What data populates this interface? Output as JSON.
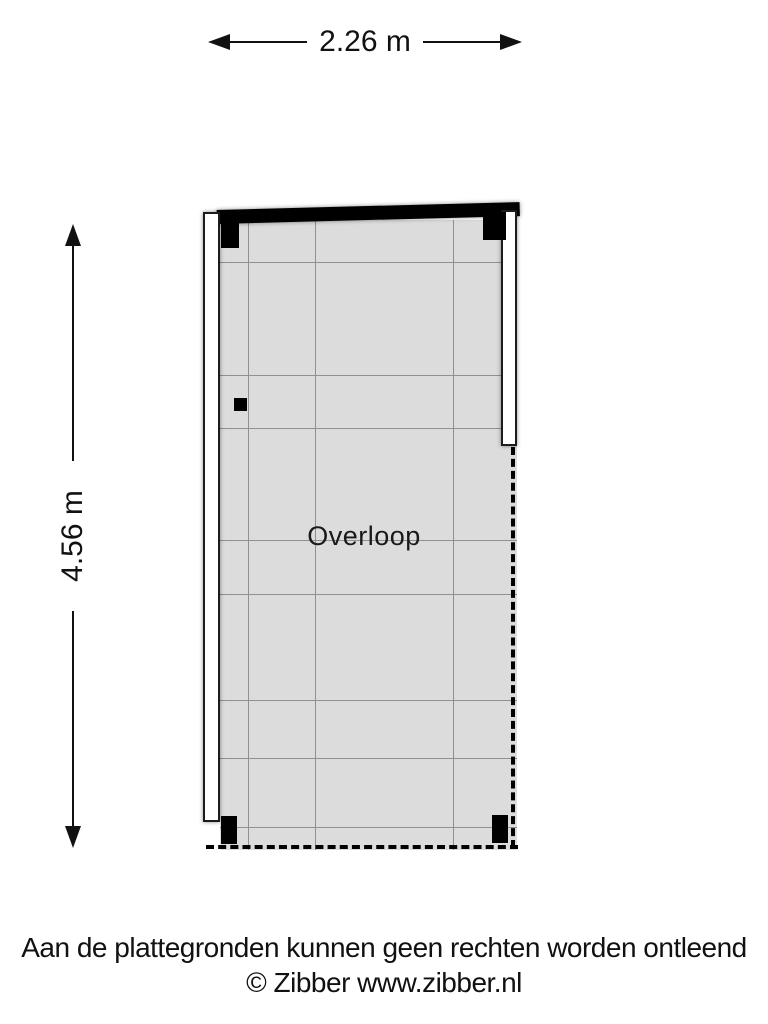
{
  "plan": {
    "room": {
      "label": "Overloop"
    },
    "dimensions": {
      "width_label": "2.26 m",
      "height_label": "4.56 m"
    }
  },
  "footer": {
    "disclaimer": "Aan de plattegronden kunnen geen rechten worden ontleend",
    "copyright": "© Zibber www.zibber.nl"
  },
  "colors": {
    "background": "#ffffff",
    "floor_fill": "#dcdcdd",
    "grid_line": "#909090",
    "wall_black": "#000000",
    "wall_white": "#ffffff",
    "ink": "#111111"
  }
}
